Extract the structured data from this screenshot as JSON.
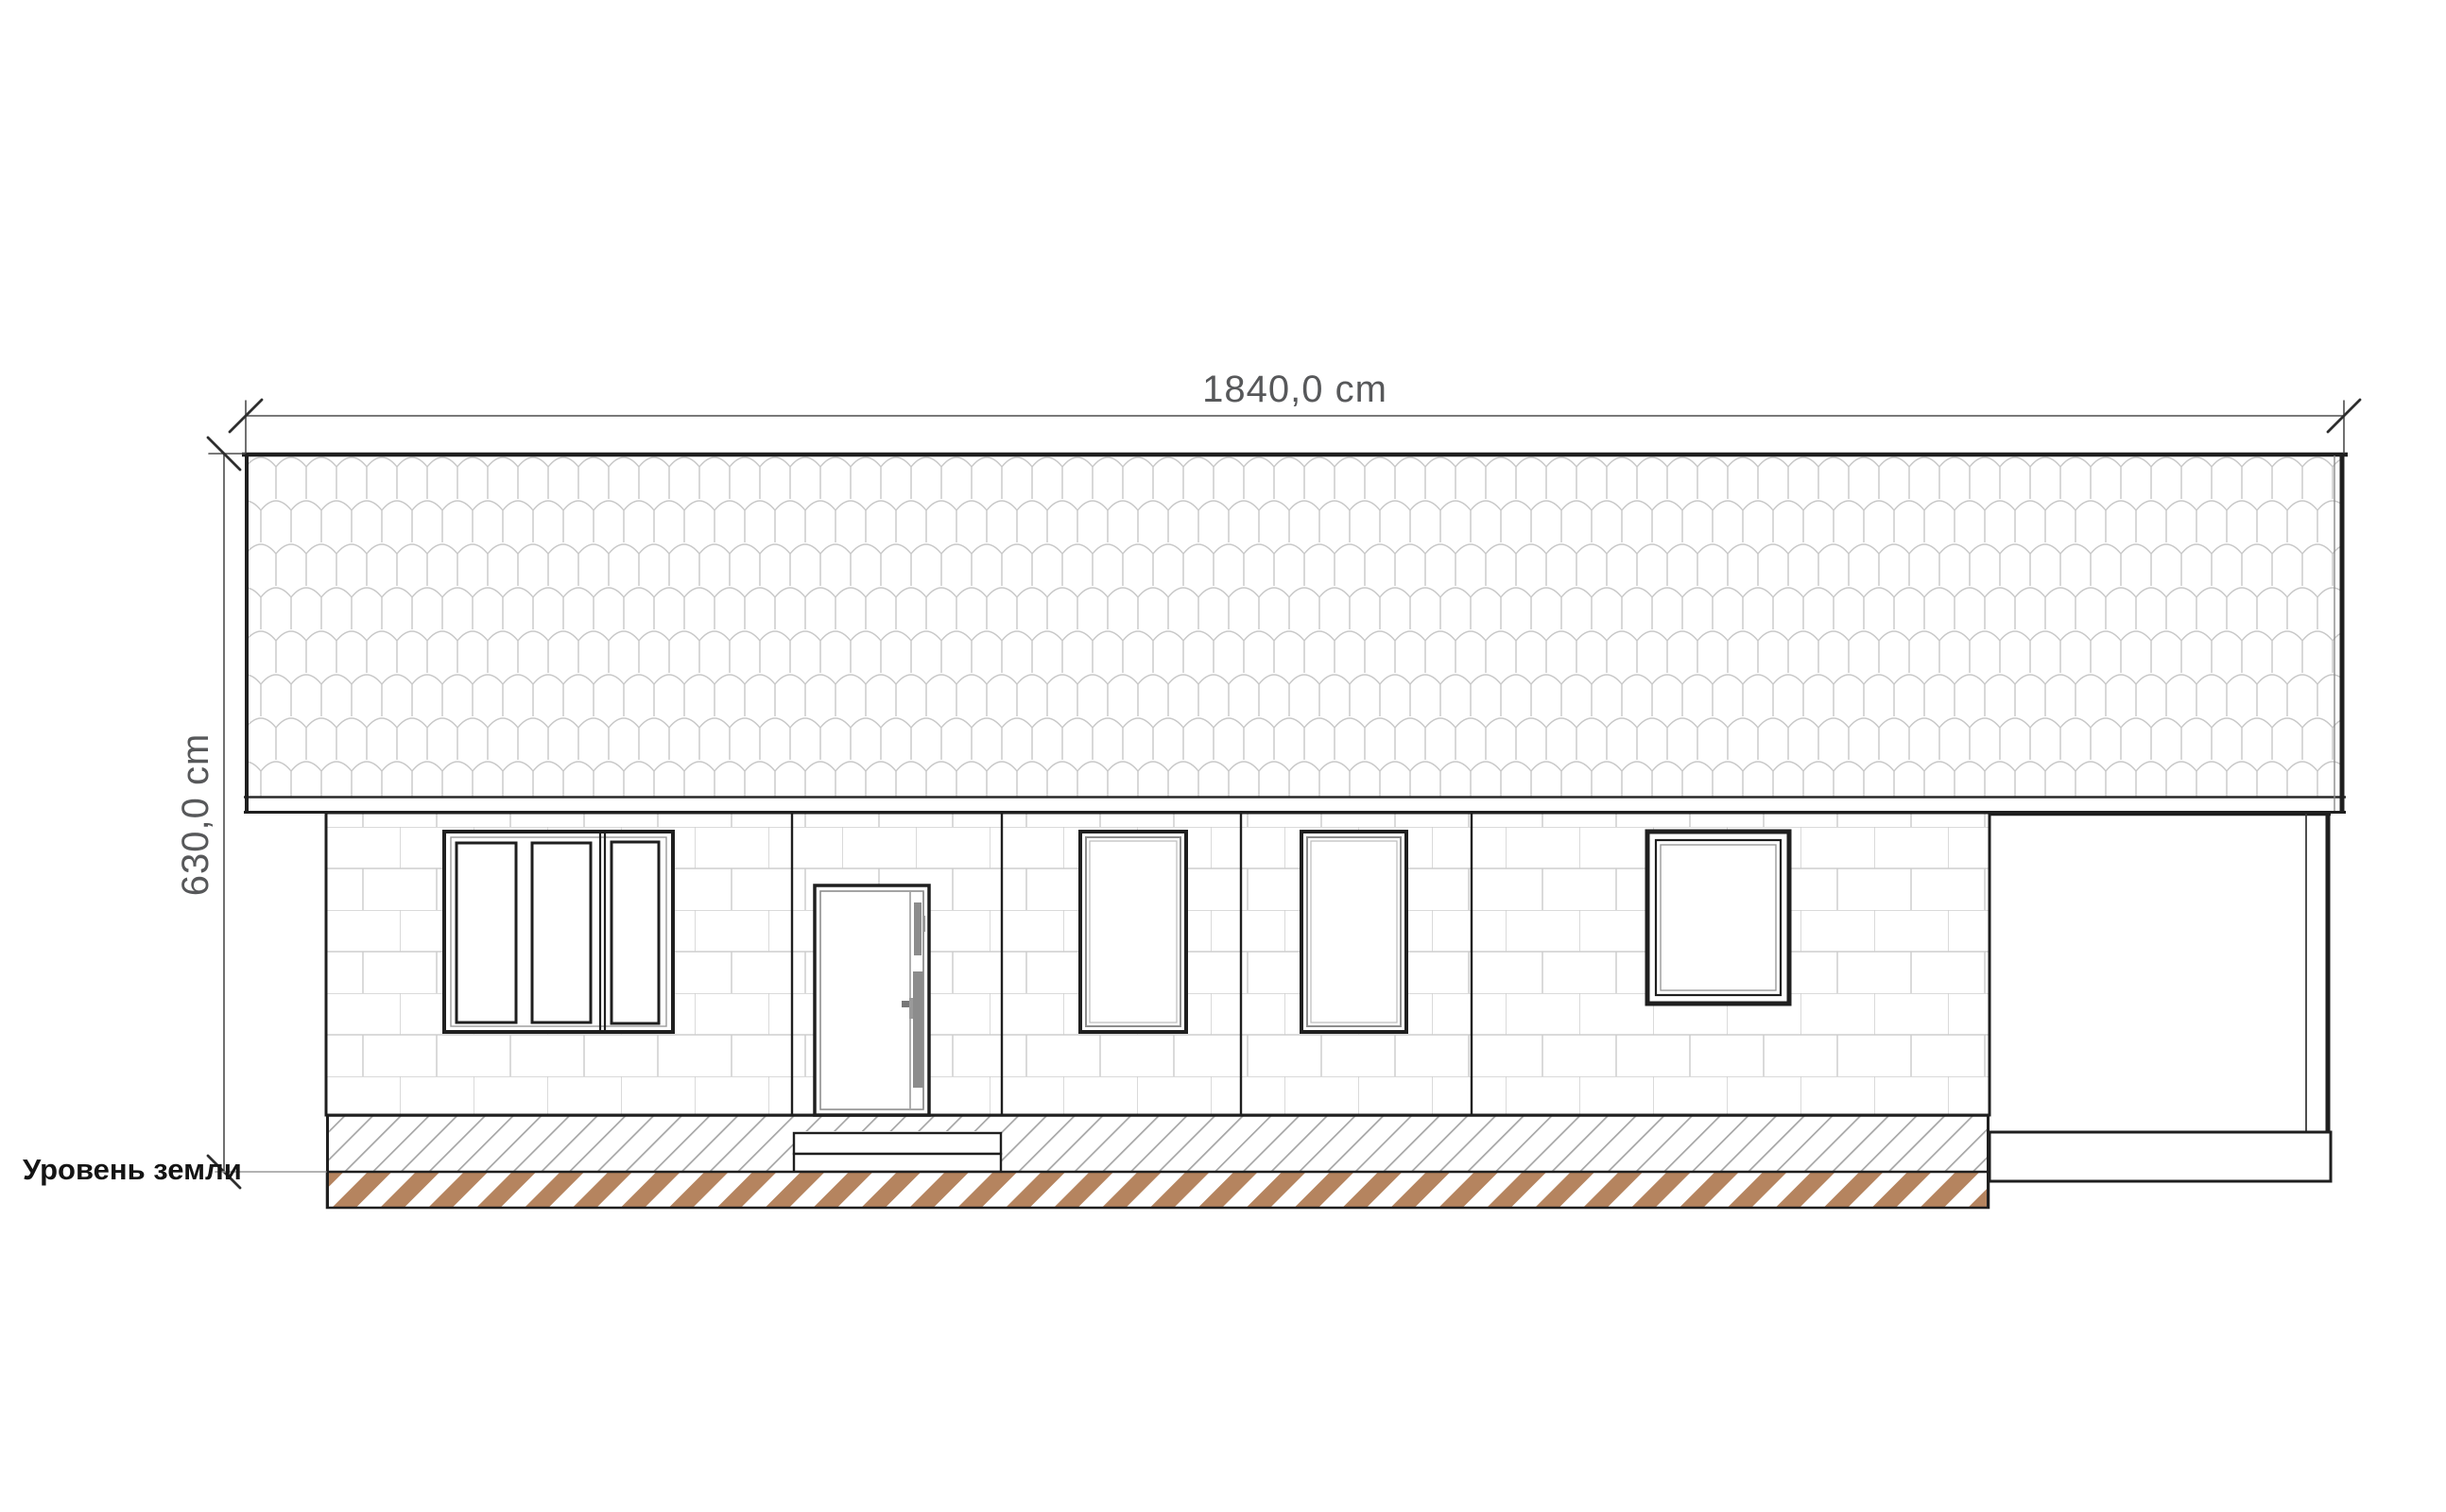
{
  "dimensions": {
    "width_label": "1840,0 cm",
    "height_label": "630,0 cm"
  },
  "labels": {
    "ground_level": "Уровень земли"
  },
  "colors": {
    "background": "#ffffff",
    "outline_dark": "#1f1f1f",
    "dimension_text": "#57585a",
    "dimension_line": "#4d4d4d",
    "brick_joint": "#cdcdcd",
    "roof_tile_line": "#c8c8c8",
    "plinth_hatch_line": "#a5a5a5",
    "foundation_stripe_brown": "#b5845f",
    "door_hardware": "#8c8c8c"
  },
  "facade": {
    "roof": "tiled-gable-roof",
    "wall": "block-masonry-wall",
    "windows": [
      {
        "id": "triple-casement-window"
      },
      {
        "id": "tall-window-left"
      },
      {
        "id": "tall-window-right"
      },
      {
        "id": "fixed-square-window"
      }
    ],
    "door": {
      "id": "entry-door",
      "steps": 2
    },
    "porch": {
      "id": "open-porch-right"
    },
    "foundation": {
      "above_ground": "hatched-plinth",
      "below_ground": "brown-striped-footing"
    }
  }
}
